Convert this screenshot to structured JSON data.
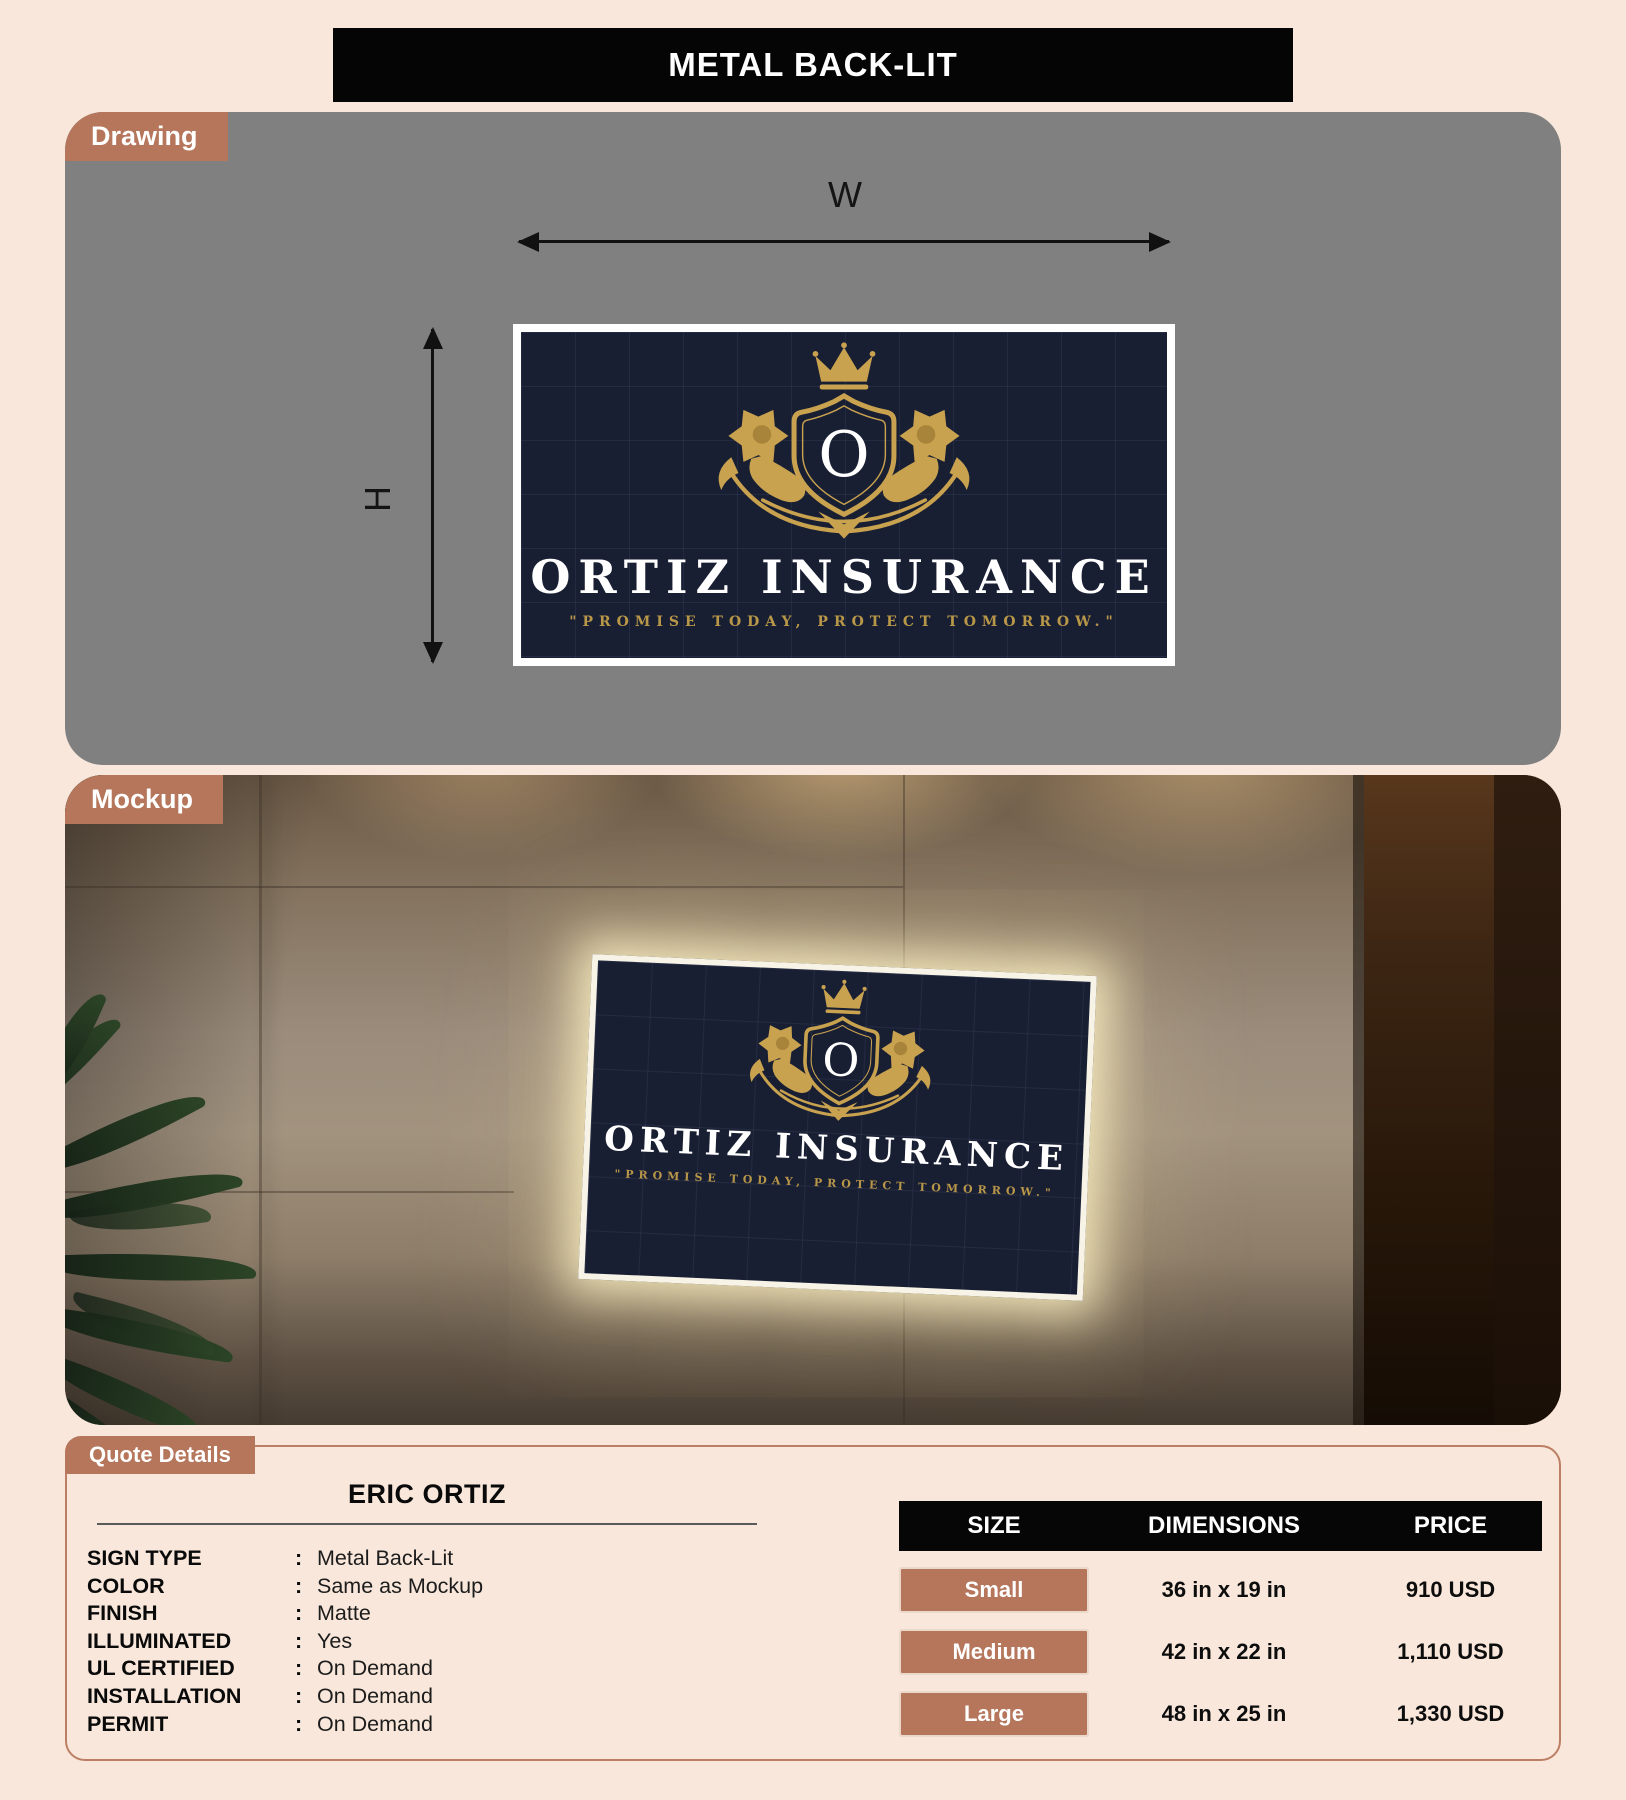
{
  "banner": {
    "title": "METAL BACK-LIT"
  },
  "drawing": {
    "label": "Drawing",
    "width_label": "W",
    "height_label": "H"
  },
  "sign": {
    "monogram": "O",
    "company": "ORTIZ INSURANCE",
    "tagline": "\"PROMISE TODAY, PROTECT TOMORROW.\"",
    "colors": {
      "panel_navy": "#191f33",
      "gold": "#c9a24f",
      "text_white": "#ffffff",
      "tagline_gold": "#b99748"
    }
  },
  "mockup": {
    "label": "Mockup"
  },
  "quote": {
    "label": "Quote Details",
    "customer": "ERIC ORTIZ",
    "separator": ":",
    "specs": [
      {
        "label": "SIGN TYPE",
        "value": "Metal Back-Lit"
      },
      {
        "label": "COLOR",
        "value": "Same as Mockup"
      },
      {
        "label": "FINISH",
        "value": "Matte"
      },
      {
        "label": "ILLUMINATED",
        "value": "Yes"
      },
      {
        "label": "UL CERTIFIED",
        "value": "On Demand"
      },
      {
        "label": "INSTALLATION",
        "value": "On Demand"
      },
      {
        "label": "PERMIT",
        "value": "On Demand"
      }
    ],
    "pricing": {
      "headers": [
        "SIZE",
        "DIMENSIONS",
        "PRICE"
      ],
      "rows": [
        {
          "size": "Small",
          "dimensions": "36 in x 19 in",
          "price": "910 USD"
        },
        {
          "size": "Medium",
          "dimensions": "42 in x 22 in",
          "price": "1,110 USD"
        },
        {
          "size": "Large",
          "dimensions": "48 in x 25 in",
          "price": "1,330 USD"
        }
      ]
    }
  },
  "colors": {
    "page_bg": "#f8e7da",
    "accent_copper": "#b5765b",
    "drawing_bg": "#808080",
    "banner_bg": "#050505",
    "panel_border": "#bc7f63"
  }
}
